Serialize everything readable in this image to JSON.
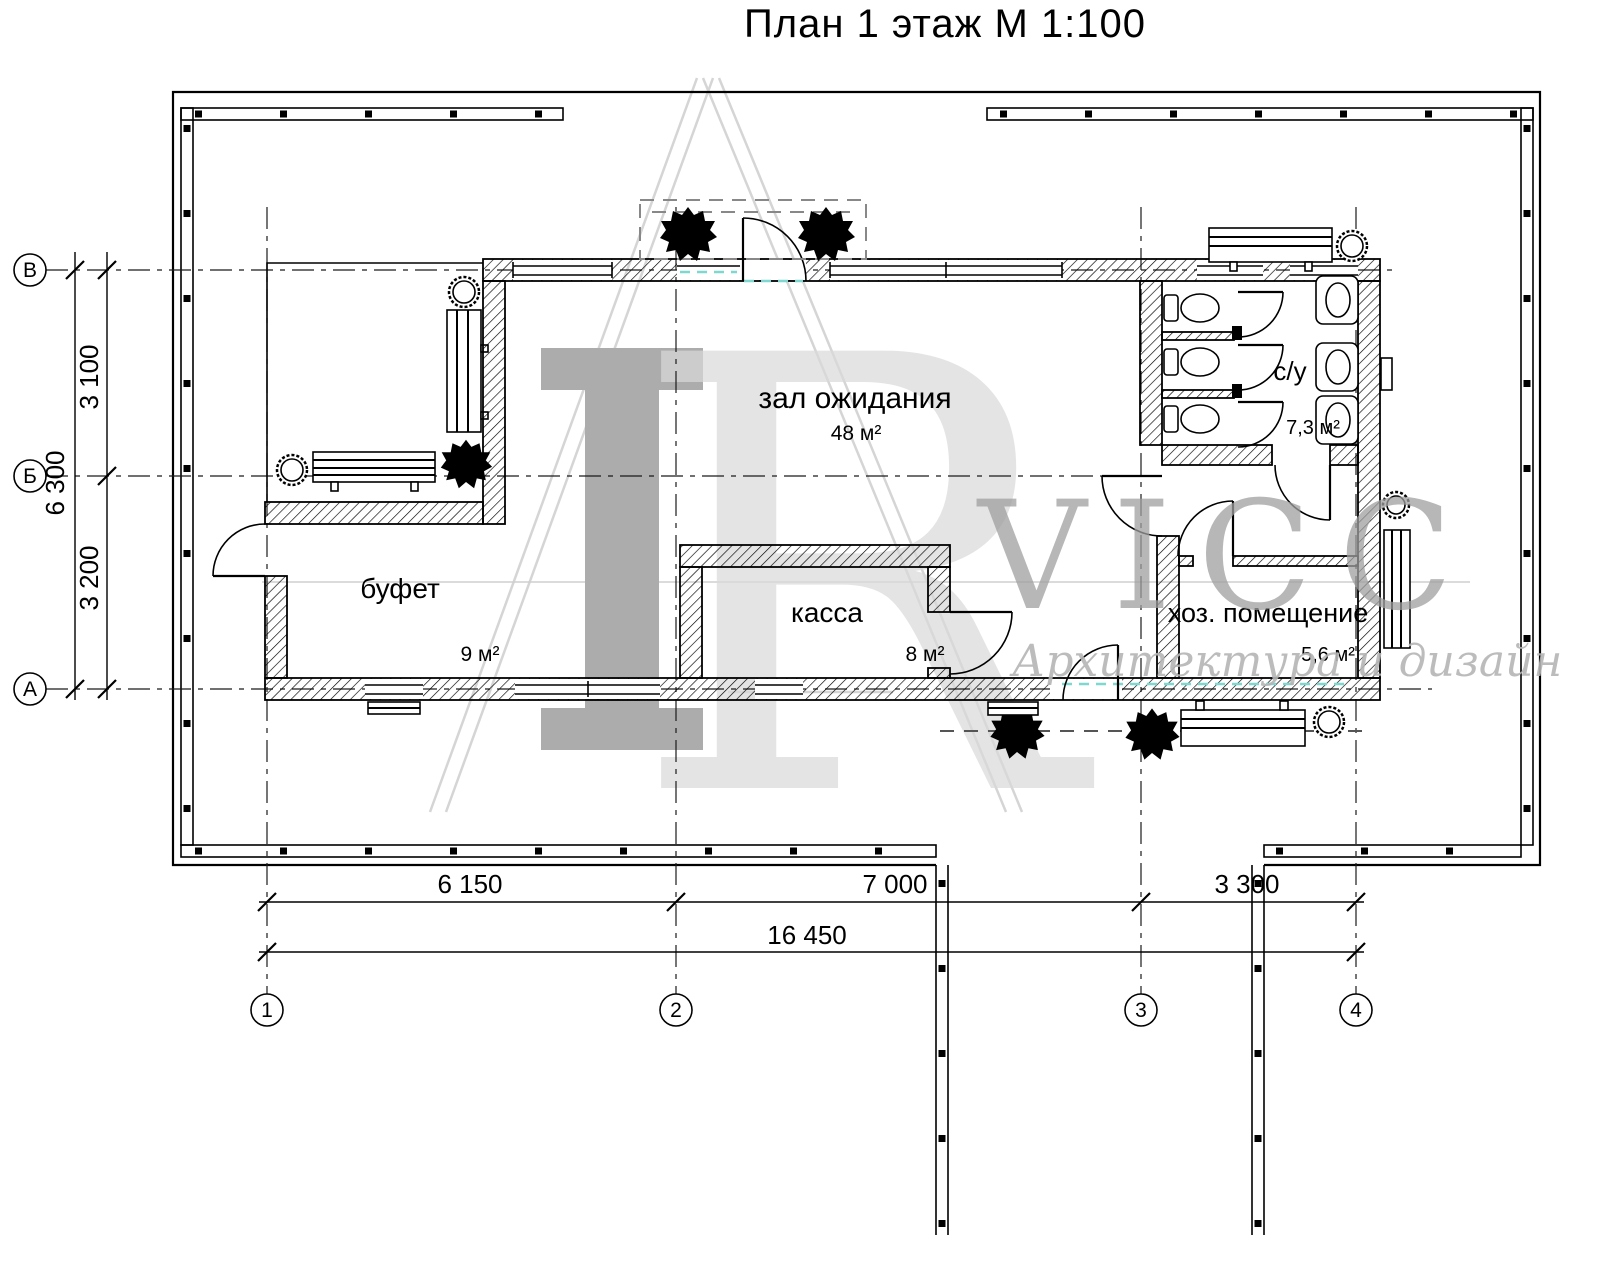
{
  "title": "План 1 этаж М 1:100",
  "rooms": {
    "hall": {
      "name": "зал ожидания",
      "area": "48 м²"
    },
    "buffet": {
      "name": "буфет",
      "area": "9 м²"
    },
    "cashier": {
      "name": "касса",
      "area": "8 м²"
    },
    "wc": {
      "name": "с/у",
      "area": "7,3 м²"
    },
    "utility": {
      "name": "хоз. помещение",
      "area": "5,6 м²"
    }
  },
  "dimensions": {
    "horizontal": {
      "d1": "6 150",
      "d2": "7 000",
      "d3": "3 300",
      "total": "16 450"
    },
    "vertical": {
      "d1": "3 100",
      "d2": "3 200",
      "total": "6 300"
    }
  },
  "axes": {
    "rows": [
      "В",
      "Б",
      "А"
    ],
    "cols": [
      "1",
      "2",
      "3",
      "4"
    ]
  },
  "watermark": {
    "letter": "R",
    "brand": "VICC",
    "tagline": "Архитектура и дизайн"
  },
  "colors": {
    "line": "#000000",
    "watermark_gray": "#a8a8a8",
    "accent_teal": "#7fd8d0"
  }
}
